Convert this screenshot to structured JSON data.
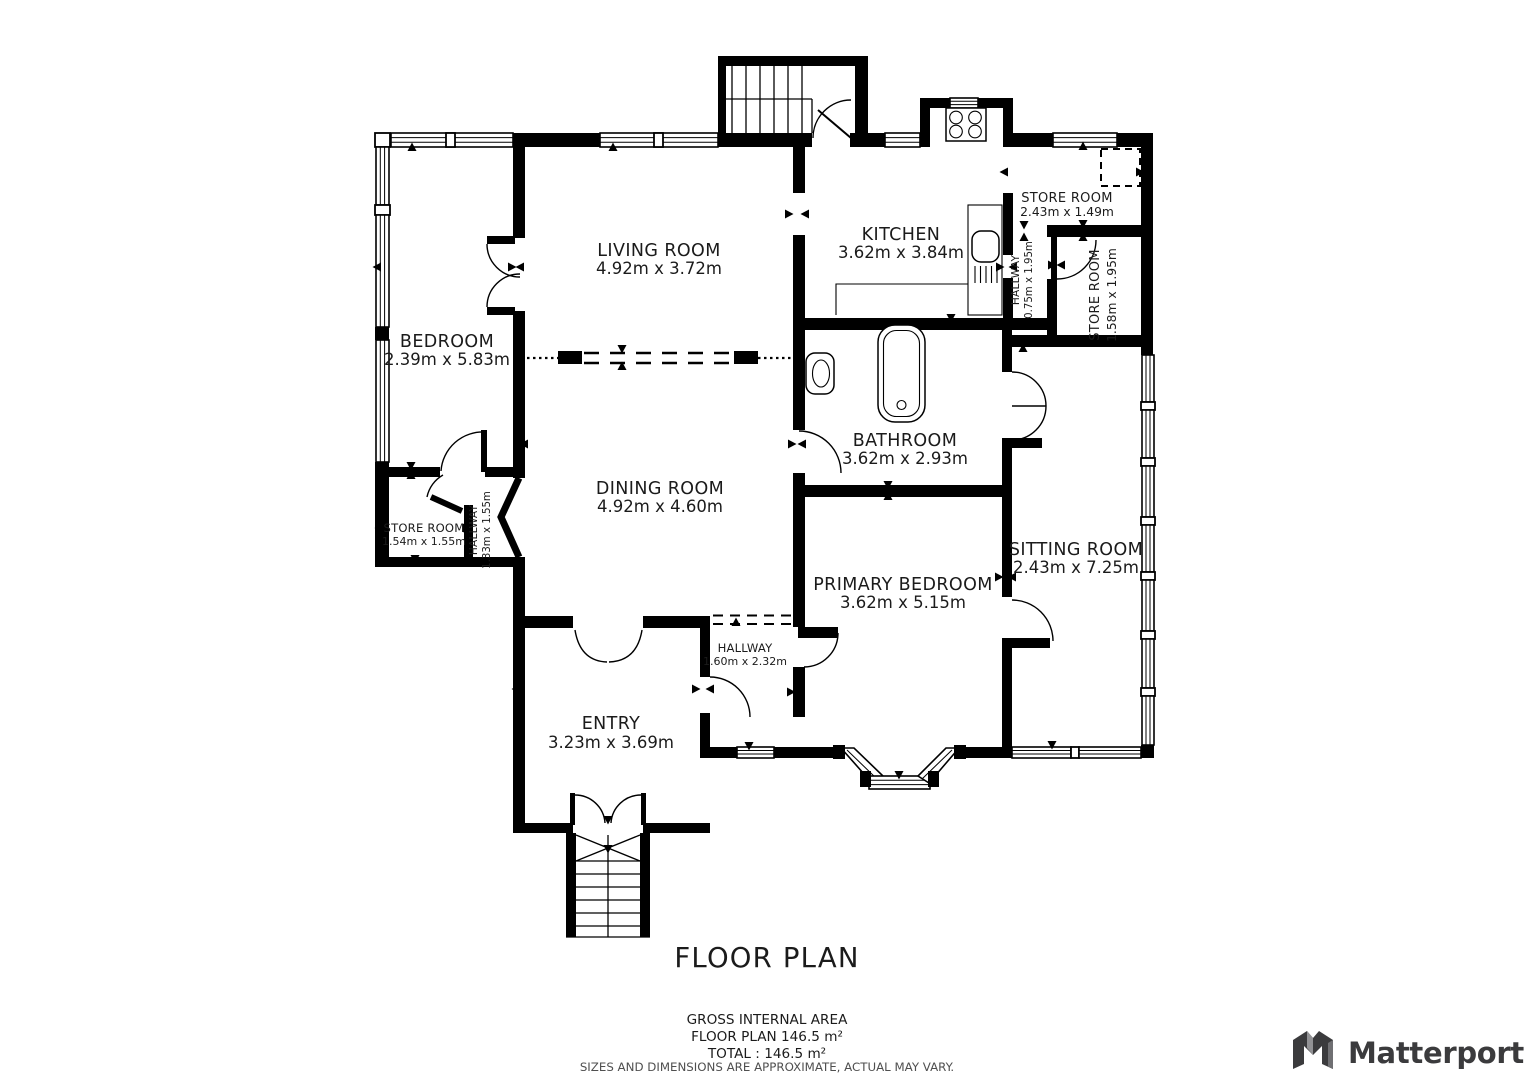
{
  "title": "FLOOR PLAN",
  "rooms": [
    {
      "name": "LIVING ROOM",
      "dims": "4.92m x 3.72m"
    },
    {
      "name": "KITCHEN",
      "dims": "3.62m x 3.84m"
    },
    {
      "name": "STORE ROOM",
      "dims": "2.43m x 1.49m"
    },
    {
      "name": "HALLWAY",
      "dims": "0.75m x 1.95m"
    },
    {
      "name": "STORE ROOM",
      "dims": "1.58m x 1.95m"
    },
    {
      "name": "BEDROOM",
      "dims": "2.39m x 5.83m"
    },
    {
      "name": "BATHROOM",
      "dims": "3.62m x 2.93m"
    },
    {
      "name": "DINING ROOM",
      "dims": "4.92m x 4.60m"
    },
    {
      "name": "STORE ROOM",
      "dims": "1.54m x 1.55m"
    },
    {
      "name": "HALLWAY",
      "dims": "1.33m x 1.55m"
    },
    {
      "name": "SITTING ROOM",
      "dims": "2.43m x 7.25m"
    },
    {
      "name": "PRIMARY BEDROOM",
      "dims": "3.62m x 5.15m"
    },
    {
      "name": "HALLWAY",
      "dims": "1.60m x 2.32m"
    },
    {
      "name": "ENTRY",
      "dims": "3.23m x 3.69m"
    }
  ],
  "footer": {
    "line1": "GROSS INTERNAL AREA",
    "line2": "FLOOR PLAN 146.5 m²",
    "line3": "TOTAL :  146.5 m²",
    "disclaimer": "SIZES AND DIMENSIONS ARE APPROXIMATE, ACTUAL MAY VARY."
  },
  "brand": {
    "name": "Matterport"
  },
  "colors": {
    "wall": "#000000",
    "text": "#1b1b1b",
    "muted": "#4f4f4f",
    "brand": "#3b3b3d",
    "background": "#ffffff"
  }
}
